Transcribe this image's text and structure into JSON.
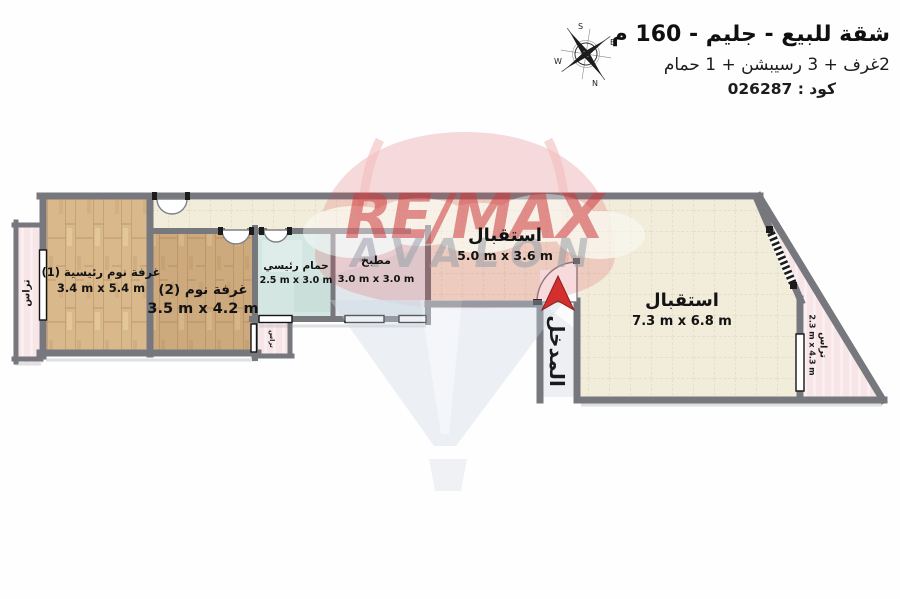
{
  "header": {
    "title": "شقة للبيع - جليم - 160 م",
    "subtitle": "2غرف + 3 رسيبشن + 1 حمام",
    "code": "كود : 026287"
  },
  "compass": {
    "top": "S",
    "bottom": "N",
    "left": "W",
    "right": "E"
  },
  "watermark": {
    "brand": "RE/MAX",
    "name": "AVALON",
    "brand_color": "#cf3a3e",
    "name_color": "#99a0a9"
  },
  "rooms": [
    {
      "id": "master-bedroom",
      "name": "غرفة نوم رئيسية (1)",
      "dimensions": "3.4 m x 5.4 m"
    },
    {
      "id": "bedroom-2",
      "name": "غرفة نوم (2)",
      "dimensions": "3.5 m x 4.2 m"
    },
    {
      "id": "master-bathroom",
      "name": "حمام رئيسي",
      "dimensions": "2.5 m x 3.0 m"
    },
    {
      "id": "kitchen",
      "name": "مطبخ",
      "dimensions": "3.0 m x 3.0 m"
    },
    {
      "id": "reception-1",
      "name": "استقبال",
      "dimensions": "5.0 m x 3.6 m"
    },
    {
      "id": "reception-2",
      "name": "استقبال",
      "dimensions": "7.3 m x 6.8 m"
    },
    {
      "id": "terrace-left",
      "name": "تراس",
      "dimensions": ""
    },
    {
      "id": "terrace-small",
      "name": "تراس",
      "dimensions": ""
    },
    {
      "id": "terrace-right",
      "name": "تراس",
      "dimensions": "2.3 m x 4.3 m"
    },
    {
      "id": "entrance",
      "name": "المدخل",
      "dimensions": ""
    }
  ],
  "colors": {
    "wall": "#7b7c82",
    "tile_floor": "#f2ecdb",
    "wood_floor": "#d9b98c",
    "bathroom_floor": "#d4e6e2",
    "kitchen_floor": "#eceef0",
    "terrace_floor": "#f7e5e8",
    "entrance_arrow": "#d32f2f",
    "balloon_red": "#d94a4f",
    "balloon_cone": "#ccd7e3"
  }
}
